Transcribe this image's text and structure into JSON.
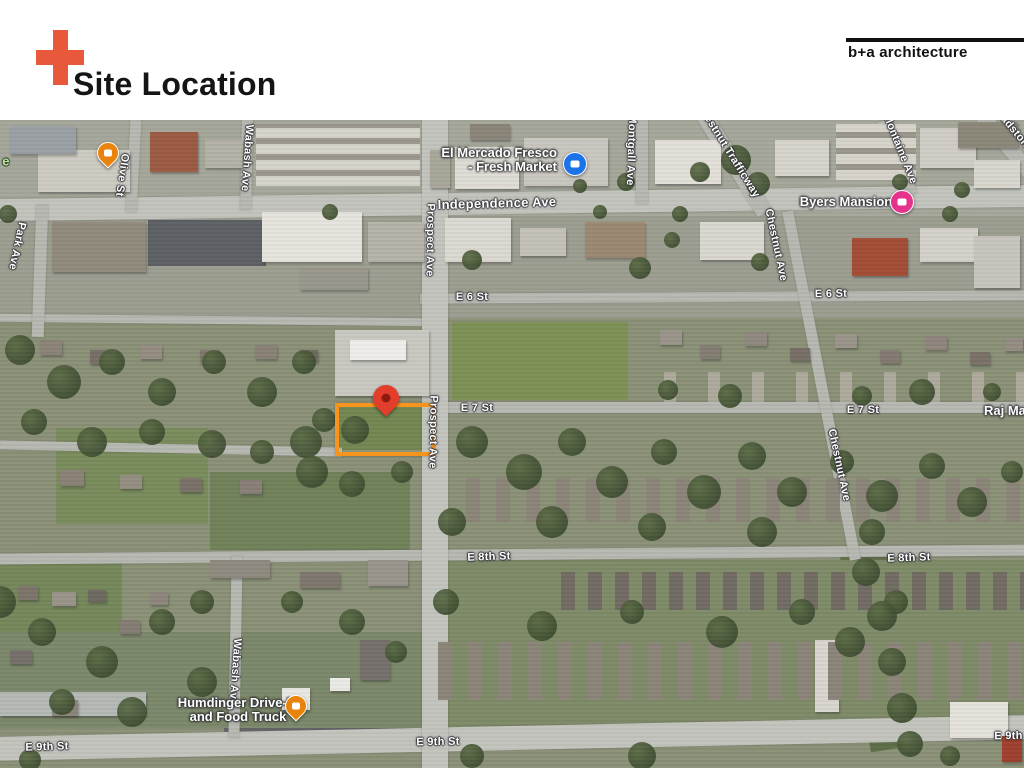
{
  "slide": {
    "title": "Site Location",
    "logo_text": "b+a architecture",
    "accent_color": "#E8593C"
  },
  "map": {
    "site_rect": {
      "x": 335,
      "y": 283,
      "w": 92,
      "h": 45,
      "color": "#F7941D"
    },
    "street_labels": [
      {
        "text": "Independence Ave",
        "x": 497,
        "y": 83,
        "rot": -1.5,
        "size": 13,
        "kind": "route"
      },
      {
        "text": "E 6 St",
        "x": 472,
        "y": 177,
        "rot": 0,
        "size": 11,
        "kind": "street"
      },
      {
        "text": "E 6 St",
        "x": 831,
        "y": 174,
        "rot": -1,
        "size": 11,
        "kind": "street"
      },
      {
        "text": "E 7 St",
        "x": 477,
        "y": 288,
        "rot": 0,
        "size": 11,
        "kind": "street"
      },
      {
        "text": "E 7 St",
        "x": 863,
        "y": 290,
        "rot": 0,
        "size": 11,
        "kind": "street"
      },
      {
        "text": "E 8th St",
        "x": 489,
        "y": 437,
        "rot": -2,
        "size": 11,
        "kind": "street"
      },
      {
        "text": "E 8th St",
        "x": 909,
        "y": 438,
        "rot": -2,
        "size": 11,
        "kind": "street"
      },
      {
        "text": "E 9th St",
        "x": 47,
        "y": 627,
        "rot": -2,
        "size": 11,
        "kind": "street"
      },
      {
        "text": "E 9th St",
        "x": 438,
        "y": 622,
        "rot": -1,
        "size": 11,
        "kind": "street"
      },
      {
        "text": "E 9th St",
        "x": 1016,
        "y": 616,
        "rot": -1,
        "size": 11,
        "kind": "street"
      },
      {
        "text": "Prospect Ave",
        "x": 430,
        "y": 120,
        "rot": 91,
        "size": 11,
        "kind": "street"
      },
      {
        "text": "Prospect Ave",
        "x": 433,
        "y": 312,
        "rot": 91,
        "size": 11,
        "kind": "street"
      },
      {
        "text": "Olive St",
        "x": 122,
        "y": 55,
        "rot": 98,
        "size": 11,
        "kind": "street"
      },
      {
        "text": "Wabash Ave",
        "x": 247,
        "y": 38,
        "rot": 94,
        "size": 11,
        "kind": "street"
      },
      {
        "text": "Wabash Ave",
        "x": 235,
        "y": 552,
        "rot": 94,
        "size": 11,
        "kind": "street"
      },
      {
        "text": "Park Ave",
        "x": 17,
        "y": 126,
        "rot": 102,
        "size": 11,
        "kind": "street"
      },
      {
        "text": "Montgall Ave",
        "x": 631,
        "y": 30,
        "rot": 92,
        "size": 11,
        "kind": "street"
      },
      {
        "text": "Chestnut Ave",
        "x": 776,
        "y": 125,
        "rot": 78,
        "size": 11,
        "kind": "street"
      },
      {
        "text": "Chestnut Ave",
        "x": 839,
        "y": 345,
        "rot": 78,
        "size": 11,
        "kind": "street"
      },
      {
        "text": "Montaine Ave",
        "x": 900,
        "y": 29,
        "rot": 68,
        "size": 11,
        "kind": "street"
      },
      {
        "text": "Gladstone Blvd",
        "x": 1022,
        "y": 20,
        "rot": 50,
        "size": 11,
        "kind": "street"
      },
      {
        "text": "Chestnut Trafficway",
        "x": 728,
        "y": 30,
        "rot": 58,
        "size": 11,
        "kind": "street"
      },
      {
        "text": "e",
        "x": 6,
        "y": 41,
        "rot": 0,
        "size": 13,
        "kind": "park"
      }
    ],
    "poi_labels": [
      {
        "id": "el-mercado-fresco",
        "lines": [
          "El Mercado Fresco",
          "- Fresh Market"
        ],
        "x": 557,
        "y": 26,
        "align": "right"
      },
      {
        "id": "byers-mansion",
        "lines": [
          "Byers Mansion"
        ],
        "x": 846,
        "y": 82,
        "align": "center"
      },
      {
        "id": "humdinger",
        "lines": [
          "Humdinger Drive-In",
          "and Food Truck"
        ],
        "x": 238,
        "y": 590,
        "align": "center"
      },
      {
        "id": "raj-mahal",
        "lines": [
          "Raj Ma H"
        ],
        "x": 984,
        "y": 284,
        "align": "left"
      }
    ],
    "markers": [
      {
        "id": "cafe-marker",
        "shape": "pin",
        "color": "#E8830C",
        "x": 107,
        "y": 32
      },
      {
        "id": "grocery-marker",
        "shape": "circle",
        "color": "#1A73E8",
        "x": 574,
        "y": 43
      },
      {
        "id": "lodging-marker",
        "shape": "circle",
        "color": "#E5328C",
        "x": 901,
        "y": 81
      },
      {
        "id": "restaurant-marker",
        "shape": "pin",
        "color": "#E8830C",
        "x": 295,
        "y": 585
      },
      {
        "id": "site-pin",
        "shape": "site-pin",
        "color": "#E33E2B",
        "inner_color": "#8E1B12",
        "x": 386,
        "y": 278
      }
    ]
  }
}
